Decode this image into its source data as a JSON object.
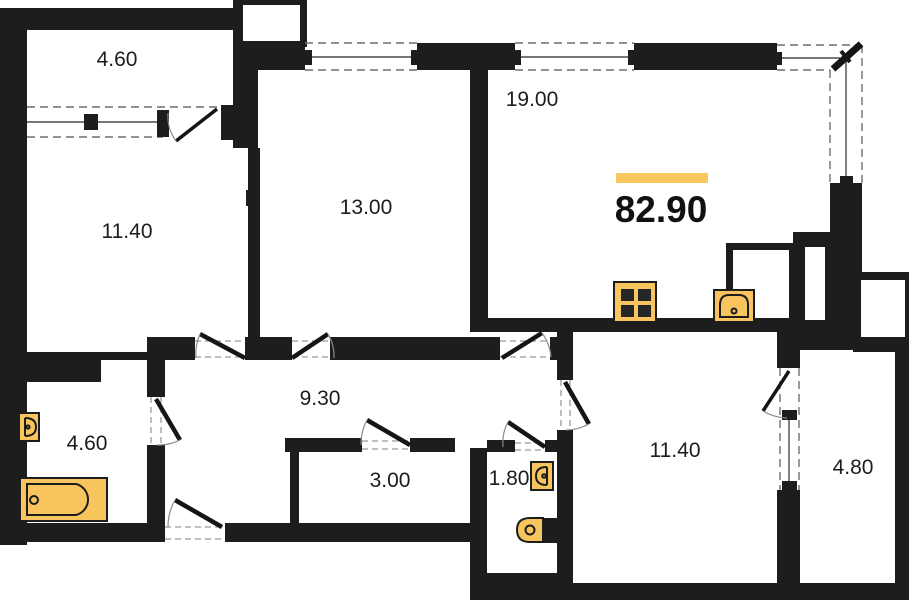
{
  "plan": {
    "total_area": "82.90",
    "rooms": [
      {
        "name": "balcony-upper",
        "area": "4.60"
      },
      {
        "name": "bedroom-upper-left",
        "area": "11.40"
      },
      {
        "name": "bedroom-middle",
        "area": "13.00"
      },
      {
        "name": "kitchen-living-room",
        "area": "19.00"
      },
      {
        "name": "hallway",
        "area": "9.30"
      },
      {
        "name": "bathroom",
        "area": "4.60"
      },
      {
        "name": "storage",
        "area": "3.00"
      },
      {
        "name": "wc",
        "area": "1.80"
      },
      {
        "name": "bedroom-lower-right",
        "area": "11.40"
      },
      {
        "name": "balcony-lower-right",
        "area": "4.80"
      }
    ],
    "fixtures": [
      {
        "name": "stove-icon"
      },
      {
        "name": "kitchen-sink-icon"
      },
      {
        "name": "bathtub-icon"
      },
      {
        "name": "washbasin-bathroom-icon"
      },
      {
        "name": "washbasin-wc-icon"
      },
      {
        "name": "toilet-icon"
      }
    ],
    "colors": {
      "wall": "#1d1d1d",
      "fixture_fill": "#F8C45E",
      "highlight_bar": "#F9C85F",
      "background": "#ffffff"
    }
  }
}
